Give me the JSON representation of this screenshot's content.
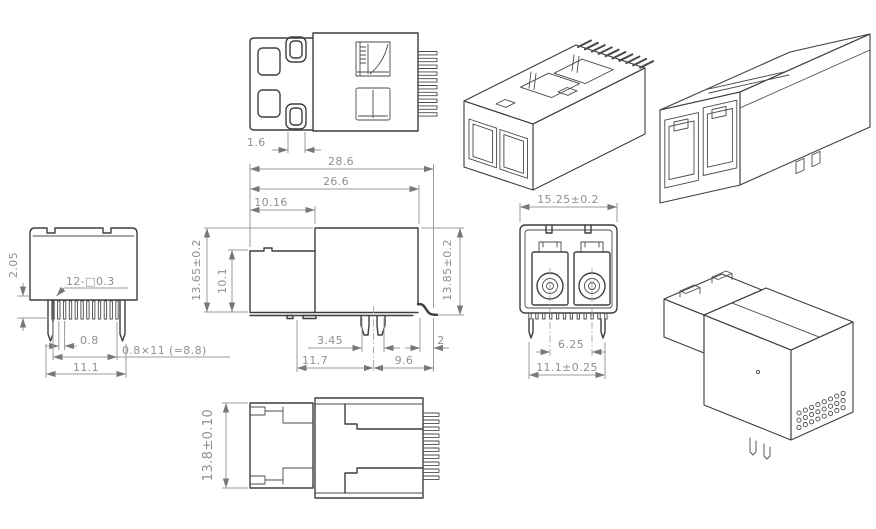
{
  "drawing": {
    "title": "Dual-port LC fiber connector — dimensioned engineering drawing",
    "background": "#ffffff",
    "colors": {
      "part_line": "#3e3e3e",
      "dimension_line": "#9b9b9b",
      "dimension_text": "#8f8f8f",
      "arrow": "#787878"
    }
  },
  "top_view": {
    "dim_latch_width": "1.6"
  },
  "side_view": {
    "dim_total_length": "28.6",
    "dim_body_length": "26.6",
    "dim_front_length": "10.16",
    "dim_overall_height": "13.65±0.2",
    "dim_front_height": "10.1",
    "dim_rear_height": "13.85±0.2",
    "dim_peg_width": "3.45",
    "dim_peg_position": "11.7",
    "dim_rear_length": "9.6",
    "dim_lead_length": "2"
  },
  "end_view": {
    "dim_pin_length": "2.05",
    "dim_pin_note": "12-□0.3",
    "dim_pin_pitch": "0.8",
    "dim_pitch_total": "0.8×11 (=8.8)",
    "dim_leg_span": "11.1"
  },
  "front_view": {
    "dim_width": "15.25±0.2",
    "dim_port_pitch": "6.25",
    "dim_leg_span": "11.1±0.25"
  },
  "bottom_view": {
    "dim_height": "13.8±0.10"
  }
}
